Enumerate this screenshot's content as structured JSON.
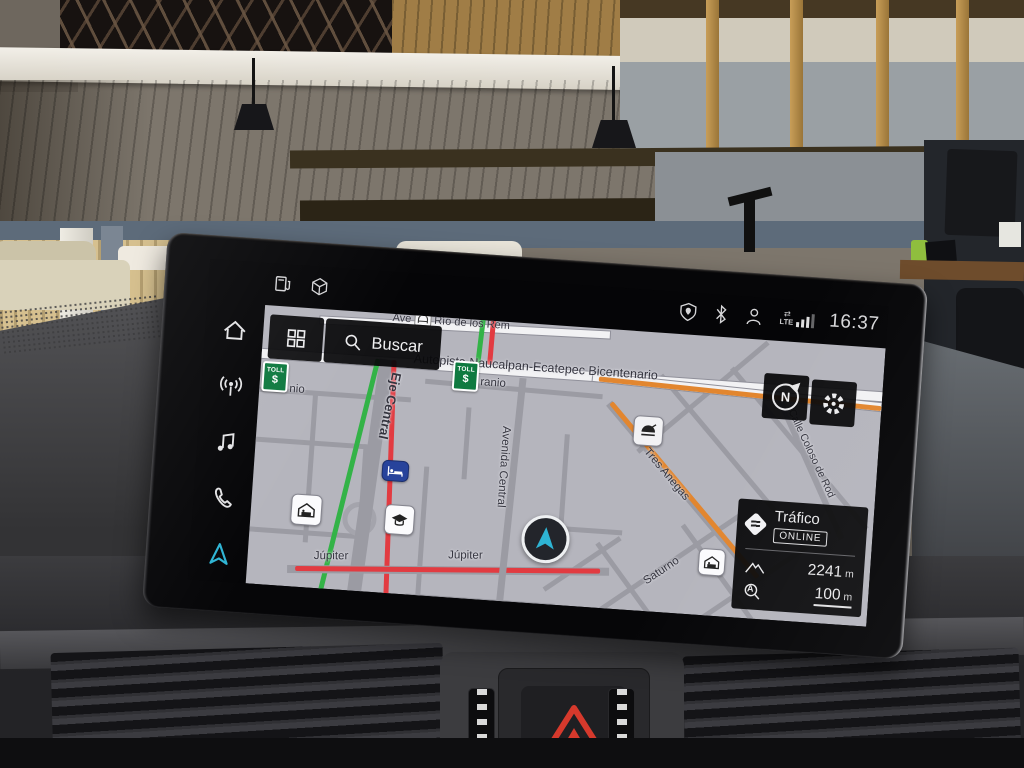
{
  "statusbar": {
    "time": "16:37",
    "lte": "LTE",
    "left_icons": [
      "fuel-pump",
      "package-cube"
    ],
    "right_icons": [
      "location-privacy-shield",
      "bluetooth",
      "driver-profile",
      "lte-signal"
    ]
  },
  "sidebar": {
    "items": [
      {
        "name": "home",
        "active": false
      },
      {
        "name": "radio",
        "active": false
      },
      {
        "name": "media",
        "active": false
      },
      {
        "name": "phone",
        "active": false
      },
      {
        "name": "navigation",
        "active": true
      }
    ]
  },
  "search": {
    "label": "Buscar"
  },
  "map": {
    "compass_label": "N",
    "streets": {
      "top_prefix": "Ave",
      "top_name": "Río de los Rem",
      "autopista": "Autopista Naucalpan-Ecatepec Bicentenario",
      "uranio_left": "nio",
      "uranio_right": "ranio",
      "eje_central": "Eje Central",
      "avenida_central": "Avenida Central",
      "jupiter": "Júpiter",
      "tres_anegas": "Tres Anegas",
      "coloso": "Calle Coloso de Rod",
      "saturno": "Saturno"
    },
    "toll": {
      "line1": "TOLL",
      "line2": "$"
    },
    "poi_icons": [
      "bridge",
      "garage",
      "school-graduation",
      "hotel-bed",
      "restaurant",
      "garage"
    ],
    "traffic_panel": {
      "title": "Tráfico",
      "status": "ONLINE",
      "altitude_value": "2241",
      "altitude_unit": "m",
      "zoom_value": "100",
      "zoom_unit": "m",
      "autozoom_letter": "A"
    }
  },
  "colors": {
    "accent_teal": "#2eb4d4",
    "traffic_green": "#33b347",
    "traffic_red": "#e23b41",
    "traffic_orange": "#e2862f",
    "toll_green": "#0f7a40",
    "hotel_blue": "#27439b",
    "map_background": "#b5b5bd"
  }
}
